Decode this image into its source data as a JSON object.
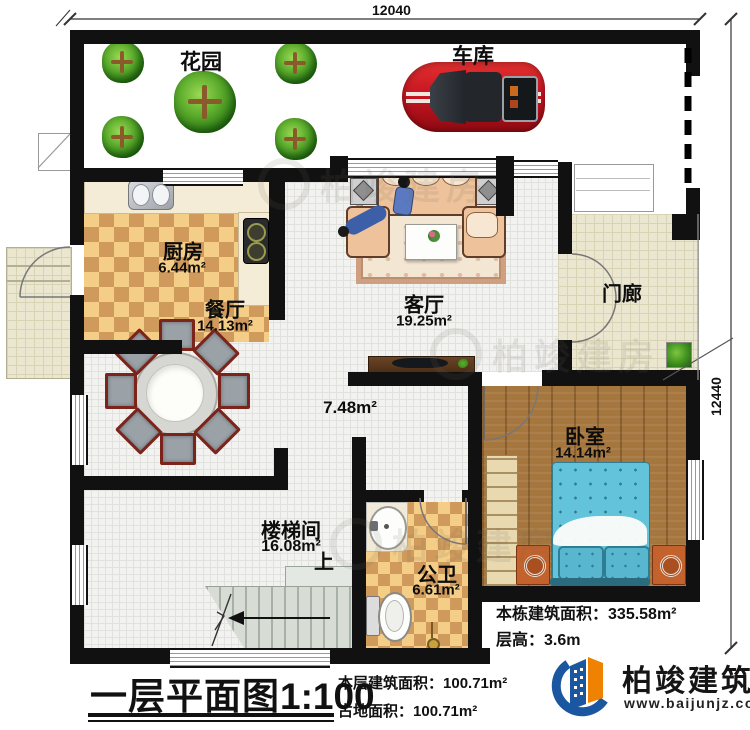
{
  "dimensions": {
    "top": "12040",
    "right": "12440"
  },
  "rooms": {
    "garden": {
      "name": "花园"
    },
    "garage": {
      "name": "车库"
    },
    "kitchen": {
      "name": "厨房",
      "area": "6.44m²"
    },
    "dining": {
      "name": "餐厅",
      "area": "14.13m²"
    },
    "living": {
      "name": "客厅",
      "area": "19.25m²"
    },
    "porch": {
      "name": "门廊"
    },
    "hall": {
      "area": "7.48m²"
    },
    "bedroom": {
      "name": "卧室",
      "area": "14.14m²"
    },
    "stairwell": {
      "name": "楼梯间",
      "area": "16.08m²",
      "up": "上"
    },
    "bathroom": {
      "name": "公卫",
      "area": "6.61m²"
    }
  },
  "annotations": {
    "building_area_label": "本栋建筑面积：",
    "building_area_value": "335.58m²",
    "storey_height_label": "层高：",
    "storey_height_value": "3.6m"
  },
  "footer": {
    "plan_title": "一层平面图",
    "plan_scale": "1:100",
    "floor_area_label": "本层建筑面积：",
    "floor_area_value": "100.71m²",
    "footprint_label": "占地面积：",
    "footprint_value": "100.71m²"
  },
  "brand": {
    "name": "柏竣建筑",
    "website": "www.baijunjz.com"
  },
  "watermark": {
    "text": "柏竣建房"
  },
  "colors": {
    "wall": "#111111",
    "brand_blue": "#1a57a0",
    "brand_orange": "#ef8200",
    "tile": "#d9a55e",
    "wood": "#a5763e",
    "bed": "#62c3da",
    "car": "#c81622"
  }
}
